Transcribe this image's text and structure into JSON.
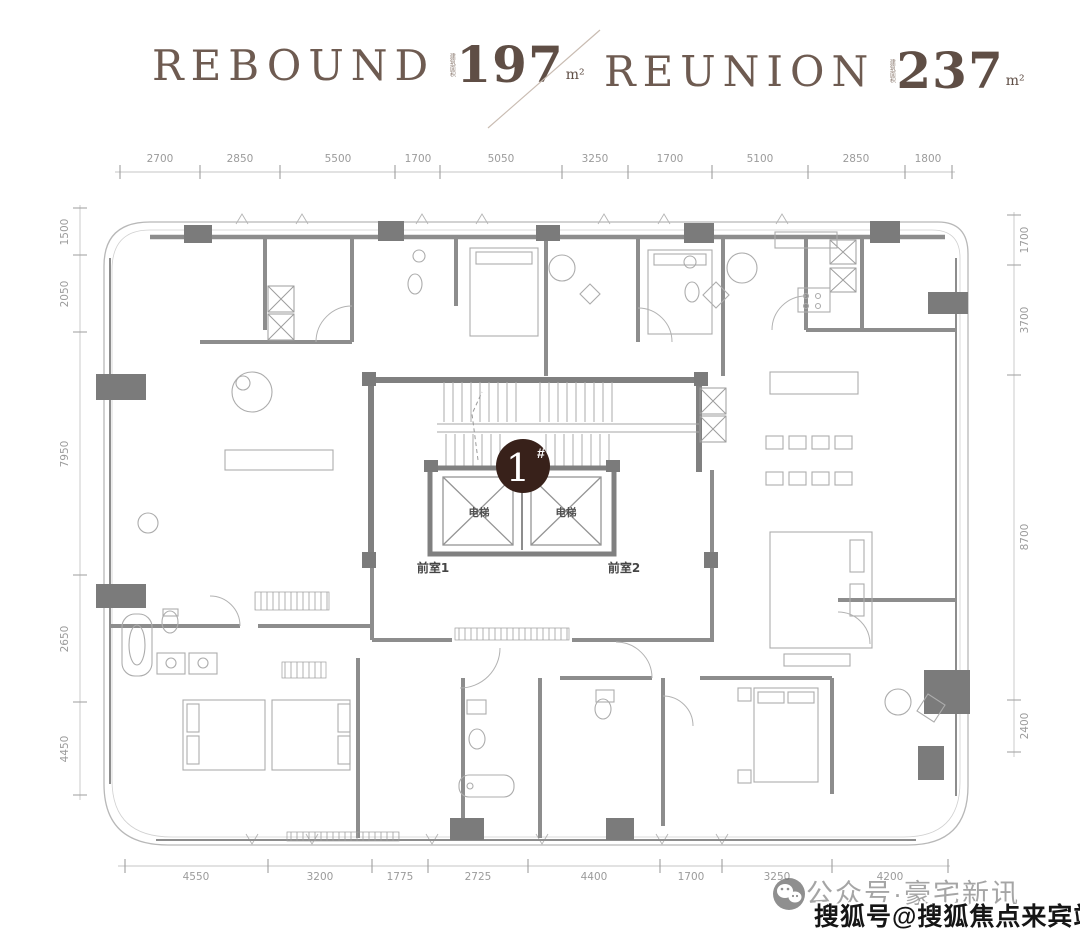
{
  "header": {
    "units": [
      {
        "name": "REBOUND",
        "area_prefix": "建筑面积",
        "area": "197",
        "unit": "m²"
      },
      {
        "name": "REUNION",
        "area_prefix": "建筑面积",
        "area": "237",
        "unit": "m²"
      }
    ]
  },
  "plan": {
    "unit_badge": {
      "number": "1",
      "suffix": "#"
    },
    "labels": {
      "elevator_left": "电梯",
      "elevator_right": "电梯",
      "front_room_1": "前室1",
      "front_room_2": "前室2"
    },
    "dimensions": {
      "top": [
        "2700",
        "2850",
        "5500",
        "1700",
        "5050",
        "3250",
        "1700",
        "5100",
        "2850",
        "1800"
      ],
      "left": [
        "1500",
        "2050",
        "7950",
        "2650",
        "4450"
      ],
      "right": [
        "1700",
        "3700",
        "8700",
        "2400"
      ],
      "bottom": [
        "4550",
        "3200",
        "1775",
        "2725",
        "4400",
        "1700",
        "3250",
        "4200"
      ]
    }
  },
  "watermark": {
    "wechat_line": "公众号·豪宅新讯",
    "sohu_line": "搜狐号@搜狐焦点来宾站"
  },
  "colors": {
    "accent_brown": "#38211a",
    "wall_gray": "#8a8a8a",
    "dim_gray": "#9b9b9b"
  }
}
